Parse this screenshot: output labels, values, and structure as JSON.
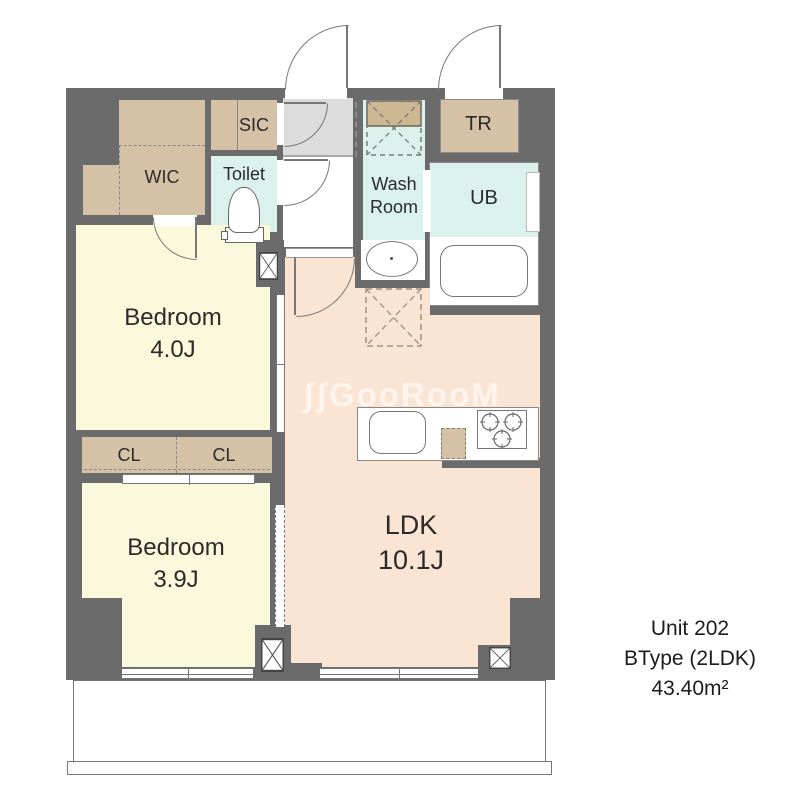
{
  "unit": {
    "line1": "Unit 202",
    "line2": "BType (2LDK)",
    "line3": "43.40m²"
  },
  "watermark": "ʃʃGooRooM",
  "rooms": {
    "wic": {
      "label": "WIC"
    },
    "sic": {
      "label": "SIC"
    },
    "toilet": {
      "label": "Toilet"
    },
    "washroom": {
      "label1": "Wash",
      "label2": "Room"
    },
    "tr": {
      "label": "TR"
    },
    "ub": {
      "label": "UB"
    },
    "bedroom1": {
      "label": "Bedroom",
      "size": "4.0J"
    },
    "bedroom2": {
      "label": "Bedroom",
      "size": "3.9J"
    },
    "cl1": {
      "label": "CL"
    },
    "cl2": {
      "label": "CL"
    },
    "ldk": {
      "label": "LDK",
      "size": "10.1J"
    }
  },
  "colors": {
    "wall": "#6b6b6b",
    "closet_tan": "#d5c1a5",
    "wet_cyan": "#daf1ec",
    "bedroom_yellow": "#fbf9dc",
    "ldk_peach": "#fae4d3",
    "entry_gray": "#dcdcdc",
    "line_gray": "#777777"
  }
}
